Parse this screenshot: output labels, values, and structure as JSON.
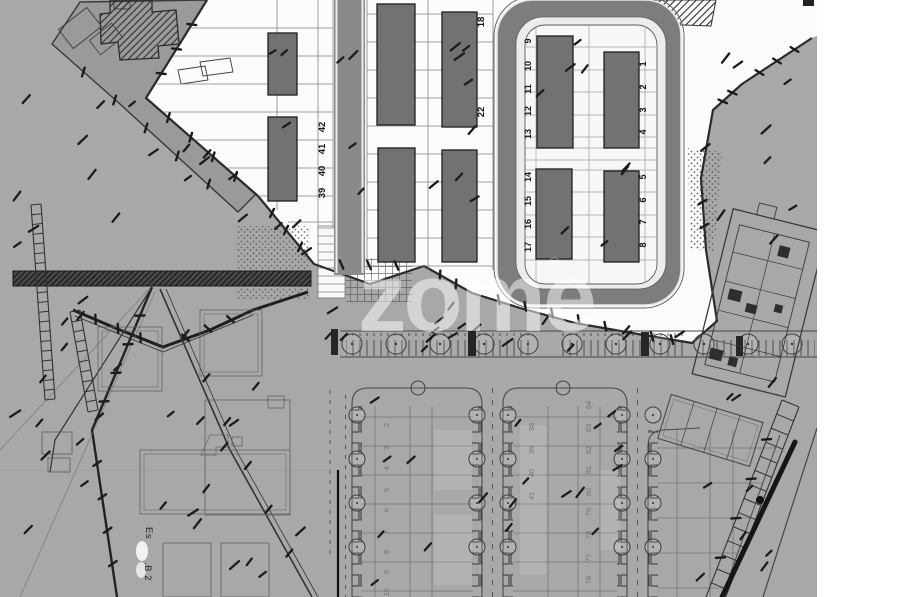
{
  "watermark": {
    "text": "zome",
    "symbol": "®"
  },
  "plots": {
    "strip_left": [
      "42",
      "41",
      "40",
      "39"
    ],
    "strip_mid": [
      "18",
      "22"
    ],
    "loop_left": [
      "9",
      "10",
      "11",
      "12",
      "13",
      "14",
      "15",
      "16",
      "17"
    ],
    "loop_right": [
      "1",
      "2",
      "3",
      "4",
      "5",
      "6",
      "7",
      "8"
    ]
  },
  "lower": {
    "block_left": [
      "2",
      "3",
      "4",
      "5",
      "6",
      "7",
      "8",
      "9",
      "10"
    ],
    "block_mid_left": [
      "38",
      "39",
      "40",
      "41"
    ],
    "block_mid_right": [
      "84",
      "83",
      "82",
      "81",
      "80",
      "79",
      "78",
      "77",
      "76"
    ]
  },
  "labels": {
    "escala": "Es",
    "b2": ".B 2"
  },
  "colors": {
    "terrain": "#a8a8a8",
    "plateau": "#9a9a9a",
    "road": "#8a8a8a",
    "loop_road": "#7d7d7d",
    "building": "#727272",
    "curb": "#ececec",
    "ink": "#1f1f1f",
    "paper": "#fbfbfb"
  }
}
